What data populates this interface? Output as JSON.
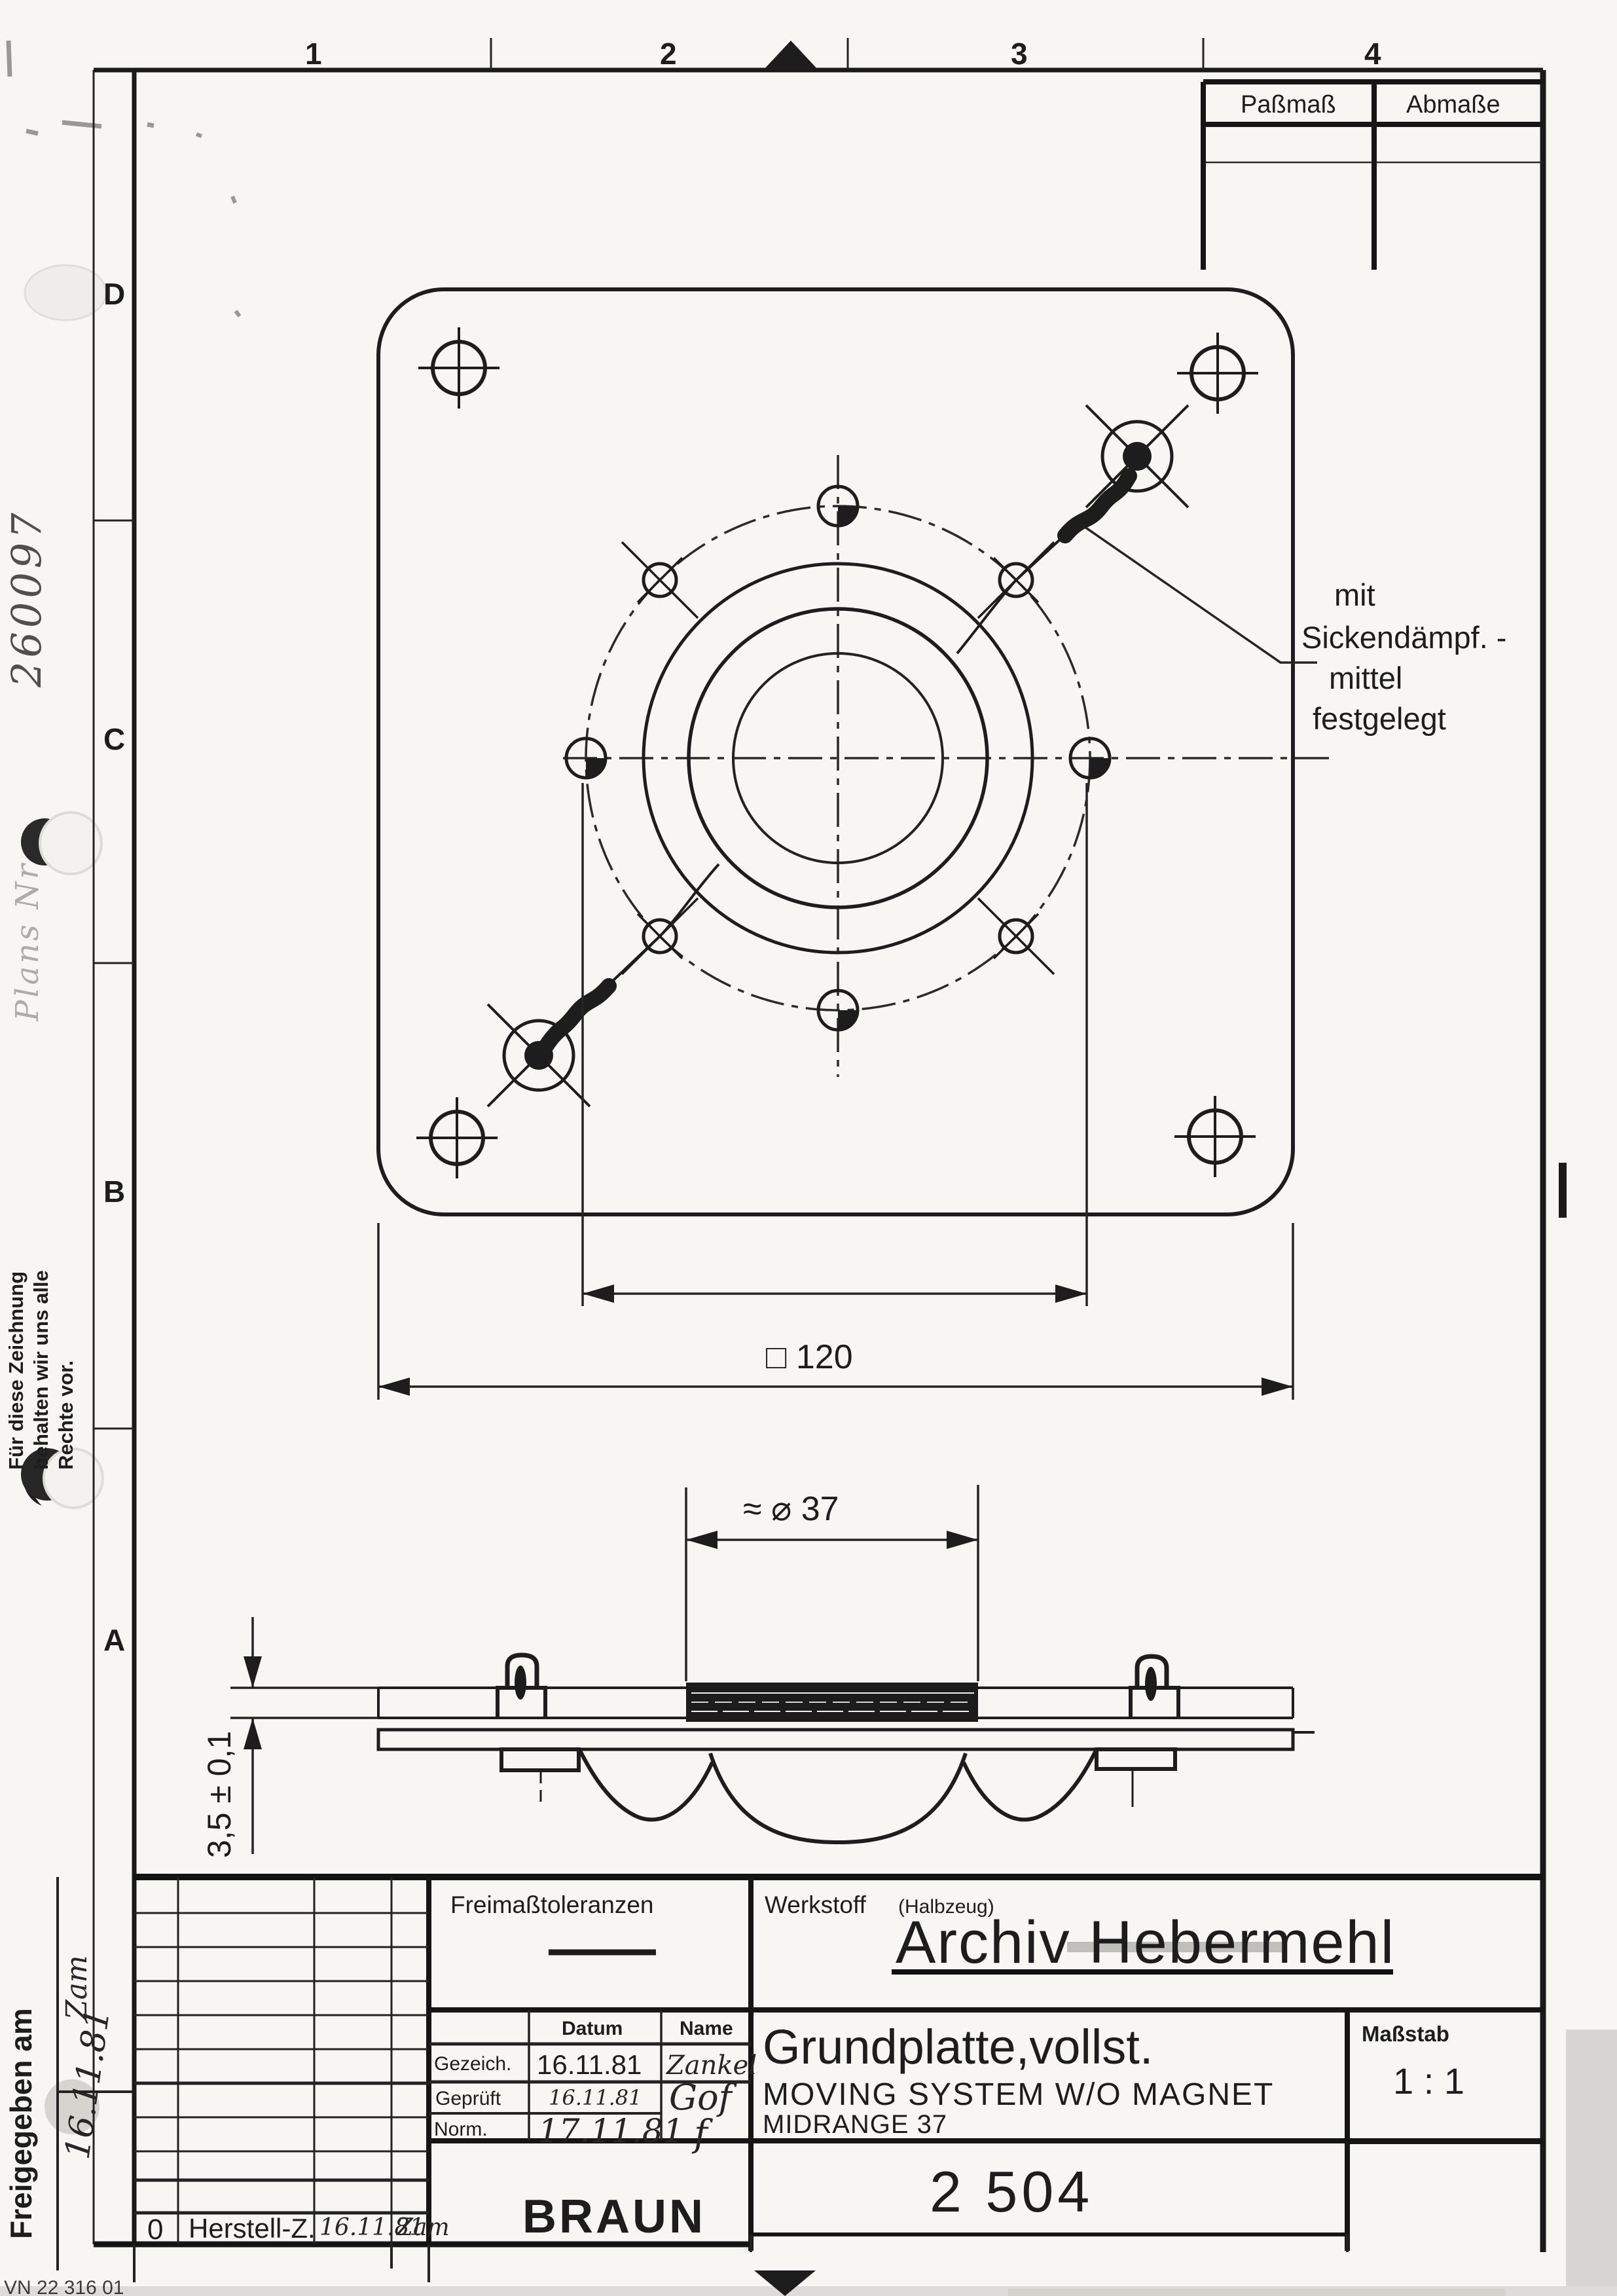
{
  "sheet": {
    "zone_numbers": {
      "n1": "1",
      "n2": "2",
      "n3": "3",
      "n4": "4"
    },
    "zone_letters": {
      "d": "D",
      "c": "C",
      "b": "B",
      "a": "A"
    },
    "fit_table": {
      "col1": "Paßmaß",
      "col2": "Abmaße"
    },
    "stamp_number": "260097",
    "stamp_label": "Plans Nr",
    "copyright_note": {
      "line1": "Für diese Zeichnung",
      "line2": "behalten wir uns alle",
      "line3": "Rechte vor."
    },
    "released_label": "Freigegeben am",
    "released_sign": "Zam",
    "released_date": "16.11.81",
    "form_number": "VN 22 316 01"
  },
  "drawing": {
    "annotation": {
      "line1": "mit",
      "line2": "Sickendämpf. -",
      "line3": "mittel",
      "line4": "festgelegt"
    },
    "dim_square": "□ 120",
    "dim_coil": "≈ ⌀ 37",
    "dim_thickness": "3,5 ± 0,1"
  },
  "title_block": {
    "tolerances_label": "Freimaßtoleranzen",
    "material_label": "Werkstoff",
    "material_label2": "(Halbzeug)",
    "archive_overlay": "Archiv Hebermehl",
    "rows": {
      "datum": "Datum",
      "name": "Name",
      "gezeich_label": "Gezeich.",
      "gezeich_date": "16.11.81",
      "gezeich_name": "Zankel",
      "gepruft_label": "Geprüft",
      "gepruft_date": "16.11.81",
      "gepruft_name": "Gof",
      "norm_label": "Norm.",
      "norm_date": "17.11.81",
      "norm_name": "f"
    },
    "title1": "Grundplatte,vollst.",
    "title2": "MOVING SYSTEM W/O MAGNET",
    "title3": "MIDRANGE 37",
    "scale_label": "Maßstab",
    "scale_value": "1 : 1",
    "brand": "BRAUN",
    "part_number": "2 504",
    "revision_row": {
      "index": "0",
      "text": "Herstell-Z.",
      "date": "16.11.81",
      "sign": "Zam"
    }
  }
}
